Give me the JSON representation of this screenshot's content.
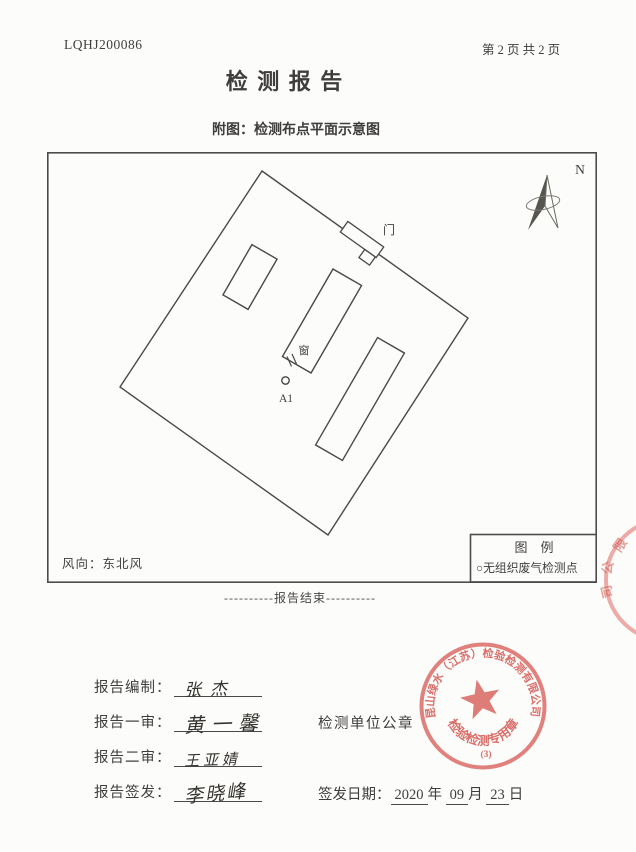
{
  "header": {
    "report_no": "LQHJ200086",
    "page_info": "第 2 页 共 2 页",
    "title": "检 测 报 告",
    "subtitle": "附图：检测布点平面示意图"
  },
  "diagram": {
    "north_label": "N",
    "door_label": "门",
    "window_label": "窗",
    "point_label": "A1",
    "wind_label": "风向：东北风",
    "legend_title": "图　例",
    "legend_item": "○无组织废气检测点"
  },
  "end_marker": "----------报告结束----------",
  "signatures": {
    "rows": [
      {
        "label": "报告编制：",
        "name": "张杰"
      },
      {
        "label": "报告一审：",
        "name": "黄一馨"
      },
      {
        "label": "报告二审：",
        "name": "王亚婧"
      },
      {
        "label": "报告签发：",
        "name": "李晓峰"
      }
    ],
    "seal_caption": "检测单位公章",
    "issue_date": {
      "label": "签发日期：",
      "year": "2020",
      "year_unit": "年",
      "month": "09",
      "month_unit": "月",
      "day": "23",
      "day_unit": "日"
    }
  },
  "seal": {
    "company": "昆山绿水（江苏）检验检测有限公司",
    "type_text": "检验检测专用章",
    "number": "(3)",
    "color": "#d5554e"
  },
  "edge_seal": {
    "chars": [
      "限",
      "公",
      "司"
    ]
  }
}
